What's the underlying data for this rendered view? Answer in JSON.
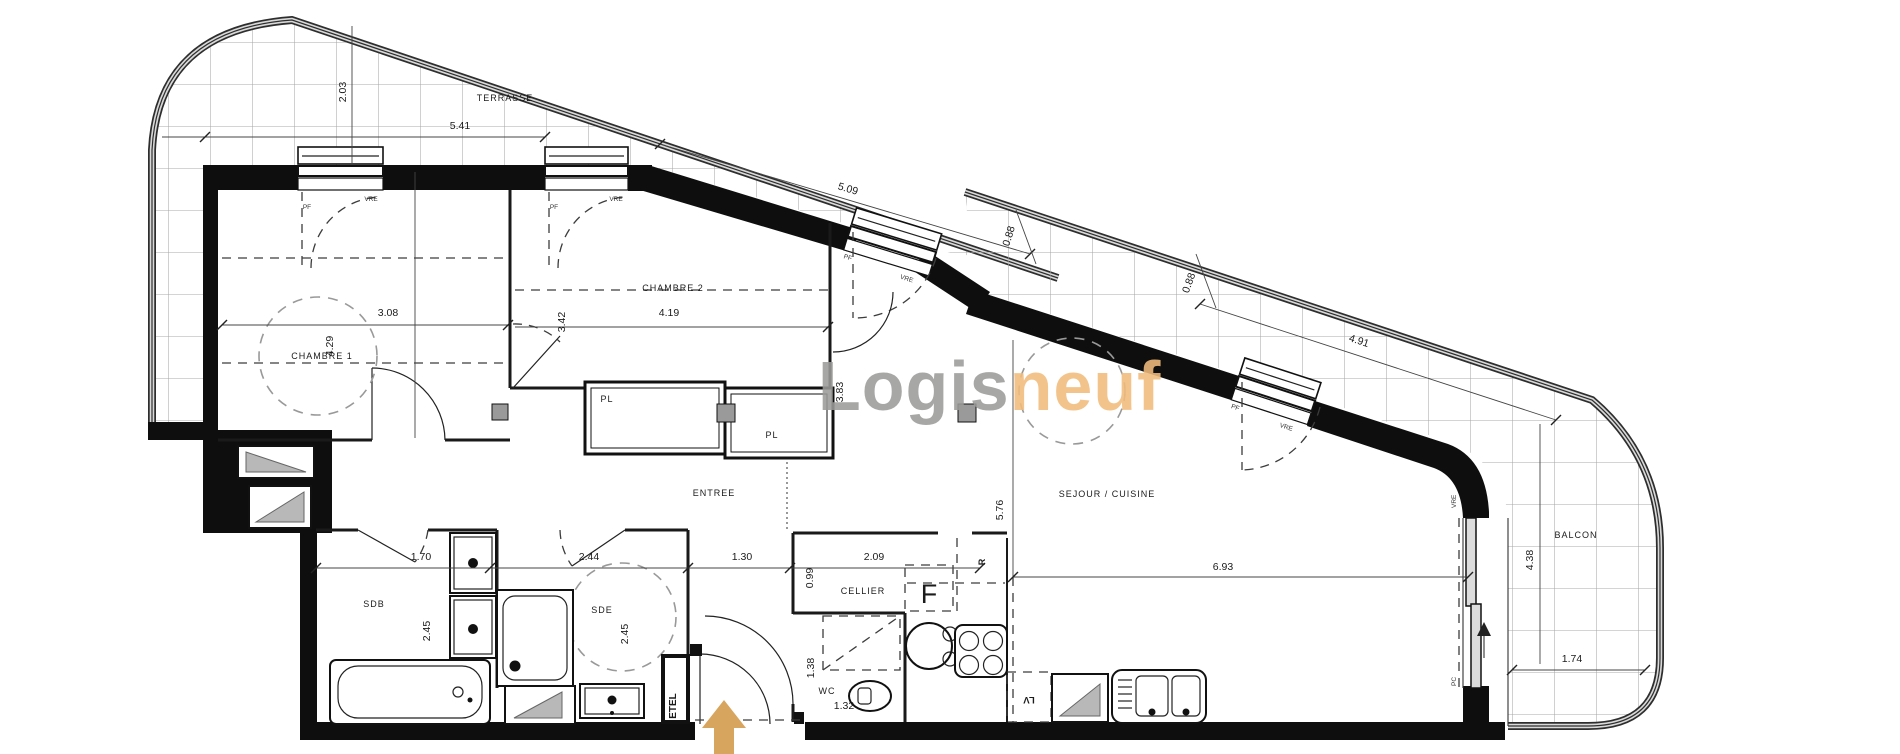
{
  "brand": {
    "part1": "Logis",
    "part2": "neuf",
    "color_gray": "#9b9b99",
    "color_orange": "#f1bc7d"
  },
  "arrow_color": "#d8a55e",
  "rooms": {
    "terrasse": "TERRASSE",
    "chambre1": "CHAMBRE 1",
    "chambre2": "CHAMBRE 2",
    "entree": "ENTREE",
    "sejour": "SEJOUR / CUISINE",
    "cellier": "CELLIER",
    "wc": "WC",
    "sdb": "SDB",
    "sde": "SDE",
    "balcon": "BALCON",
    "pl1": "PL",
    "pl2": "PL"
  },
  "tech": {
    "etel": "ETEL",
    "fridge": "F",
    "dishwasher": "LV",
    "hob": "R"
  },
  "openings": {
    "pf": "PF",
    "vre": "VRE",
    "pc": "PC"
  },
  "dims": {
    "d203": "2.03",
    "d541": "5.41",
    "d509": "5.09",
    "d088a": "0.88",
    "d088b": "0.88",
    "d491": "4.91",
    "d308": "3.08",
    "d429": "4.29",
    "d342": "3.42",
    "d419": "4.19",
    "d383": "3.83",
    "d576": "5.76",
    "d693": "6.93",
    "d438": "4.38",
    "d174": "1.74",
    "d170": "1.70",
    "d244": "2.44",
    "d130": "1.30",
    "d099": "0.99",
    "d209": "2.09",
    "d245a": "2.45",
    "d245b": "2.45",
    "d138": "1.38",
    "d132": "1.32"
  }
}
